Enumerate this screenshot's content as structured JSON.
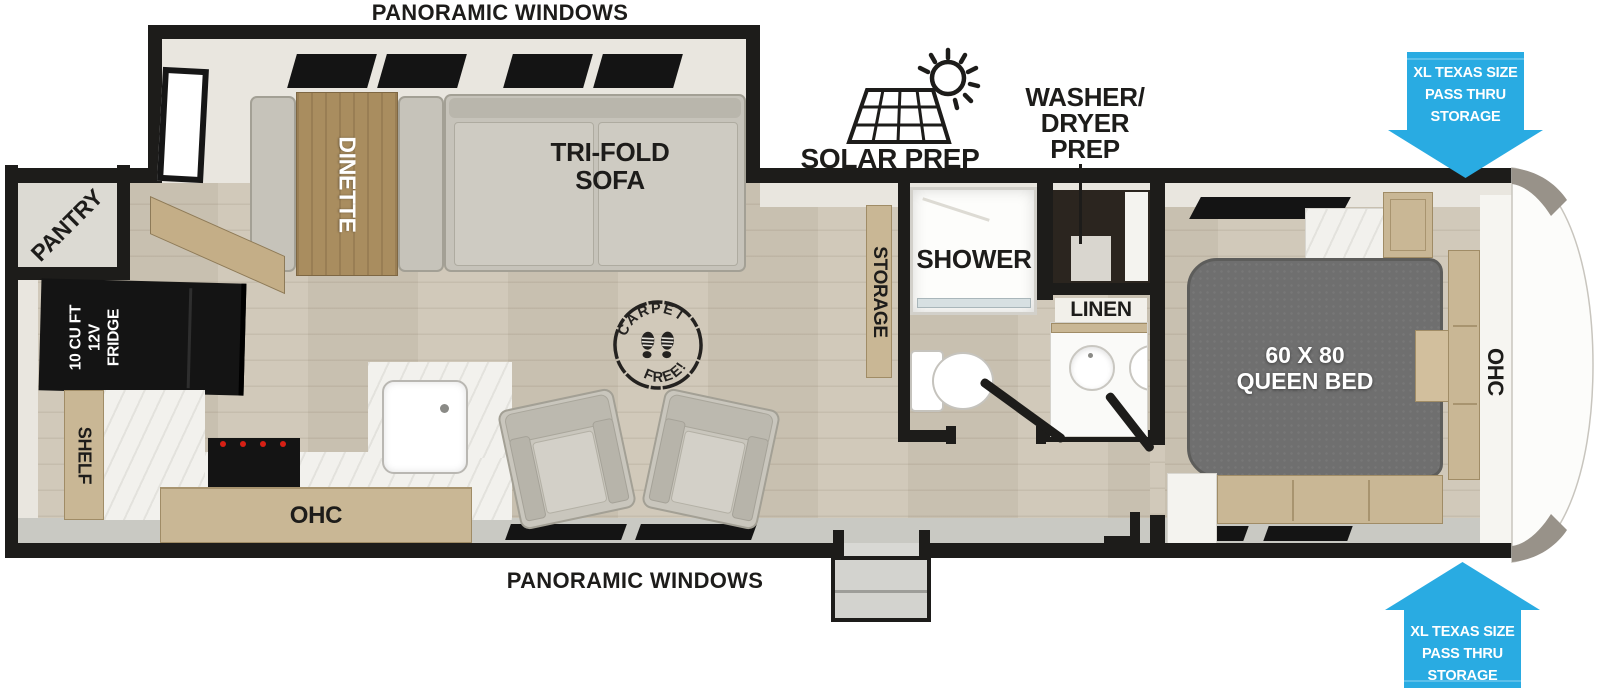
{
  "exterior": {
    "panoramic_top": "PANORAMIC WINDOWS",
    "panoramic_bottom": "PANORAMIC WINDOWS",
    "solar_prep": "SOLAR PREP",
    "washer_dryer_prep": {
      "line1": "WASHER/",
      "line2": "DRYER",
      "line3": "PREP"
    },
    "pass_thru": {
      "line1": "XL TEXAS SIZE",
      "line2": "PASS THRU",
      "line3": "STORAGE"
    }
  },
  "rooms": {
    "living": {
      "dinette": "DINETTE",
      "trifold": {
        "line1": "TRI-FOLD",
        "line2": "SOFA"
      },
      "carpet_stamp": {
        "top": "CARPET",
        "bottom": "FREE!"
      },
      "storage_divider": "STORAGE"
    },
    "kitchen": {
      "pantry": "PANTRY",
      "fridge": {
        "line1": "10 CU FT",
        "line2": "12V",
        "line3": "FRIDGE"
      },
      "shelf": "SHELF",
      "ohc": "OHC"
    },
    "bathroom": {
      "shower": "SHOWER",
      "linen": "LINEN"
    },
    "bedroom": {
      "bed": {
        "line1": "60 X 80",
        "line2": "QUEEN BED"
      },
      "ohc": "OHC"
    }
  },
  "colors": {
    "arrow_blue": "#29ABE2",
    "wall_black": "#1d1c1a",
    "wood_floor": "#cec6b6",
    "cabinet_tan": "#c9b795",
    "bed_gray": "#6f6f6f",
    "counter_marble": "#f2f1ed",
    "slide_cream": "#e9e6df"
  }
}
